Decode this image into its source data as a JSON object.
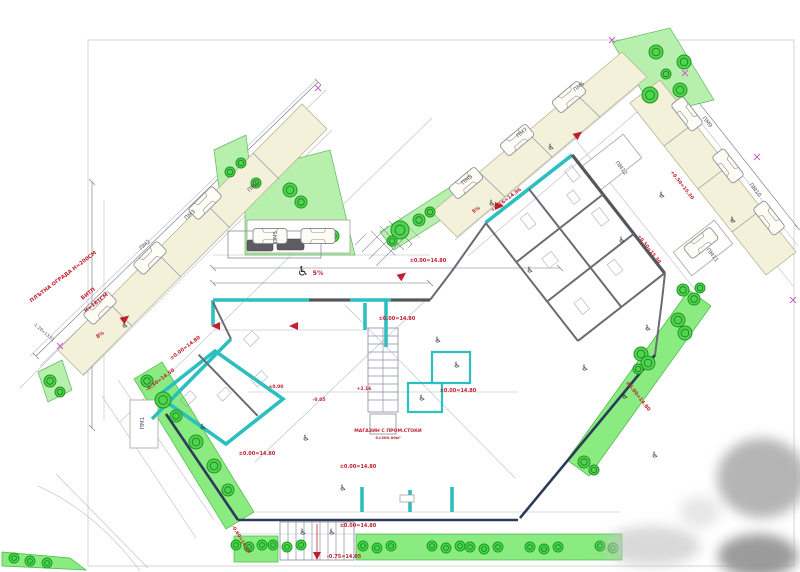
{
  "drawing": {
    "kind": "architectural site / ground-floor plan",
    "colors": {
      "wall_new_teal": "#2cbfbf",
      "wall_existing_gray": "#55575e",
      "wall_front_navy": "#2d3b58",
      "annotation_red": "#c11f2e",
      "landscape_green": "#8aeb80",
      "parking_beige": "#f4f1da",
      "survey_magenta": "#c75bc7"
    },
    "icons": {
      "wheelchair": "♿",
      "survey_cross": "✕"
    },
    "texts": [
      {
        "name": "fence-label",
        "text": "ПЛЪТНА ОГРАДА Н=200СМ",
        "x": 64,
        "y": 278,
        "rot": -37,
        "size": 5.2,
        "cls": "t-red"
      },
      {
        "name": "bitp-label-1",
        "text": "БИТП",
        "x": 89,
        "y": 295,
        "rot": -37,
        "size": 5.2,
        "cls": "t-red"
      },
      {
        "name": "bitp-label-2",
        "text": "Н=181СМ",
        "x": 97,
        "y": 304,
        "rot": -37,
        "size": 5.2,
        "cls": "t-red"
      },
      {
        "name": "level-mark",
        "text": "±0.00=14.80",
        "x": 428,
        "y": 262,
        "rot": 0,
        "size": 5,
        "cls": "t-red"
      },
      {
        "name": "level-mark",
        "text": "±0.00=14.80",
        "x": 397,
        "y": 320,
        "rot": 0,
        "size": 5,
        "cls": "t-red"
      },
      {
        "name": "level-mark",
        "text": "±0.00=14.80",
        "x": 458,
        "y": 392,
        "rot": 0,
        "size": 5,
        "cls": "t-red"
      },
      {
        "name": "level-mark",
        "text": "±0.00=14.80",
        "x": 358,
        "y": 468,
        "rot": 0,
        "size": 5,
        "cls": "t-red"
      },
      {
        "name": "level-mark",
        "text": "±0.00=14.80",
        "x": 257,
        "y": 455,
        "rot": 0,
        "size": 5,
        "cls": "t-red"
      },
      {
        "name": "level-mark",
        "text": "±0.00=14.80",
        "x": 358,
        "y": 527,
        "rot": 0,
        "size": 5,
        "cls": "t-red"
      },
      {
        "name": "level-mark",
        "text": "±0.00=14.80",
        "x": 186,
        "y": 349,
        "rot": -37,
        "size": 5,
        "cls": "t-red"
      },
      {
        "name": "level-mark",
        "text": "±0.00=14.80",
        "x": 637,
        "y": 397,
        "rot": 52,
        "size": 5,
        "cls": "t-red"
      },
      {
        "name": "level-mark",
        "text": "-0.75=14.05",
        "x": 344,
        "y": 558,
        "rot": 0,
        "size": 5,
        "cls": "t-red"
      },
      {
        "name": "level-mark",
        "text": "-0.30=14.50",
        "x": 161,
        "y": 381,
        "rot": -37,
        "size": 5,
        "cls": "t-red"
      },
      {
        "name": "level-mark",
        "text": "-0.60=14.14",
        "x": 240,
        "y": 540,
        "rot": 58,
        "size": 4.6,
        "cls": "t-red"
      },
      {
        "name": "level-mark",
        "text": "+0.16=14.96",
        "x": 507,
        "y": 201,
        "rot": -37,
        "size": 5,
        "cls": "t-red"
      },
      {
        "name": "level-mark",
        "text": "+0.50=15.30",
        "x": 681,
        "y": 186,
        "rot": 52,
        "size": 4.8,
        "cls": "t-red"
      },
      {
        "name": "level-mark",
        "text": "+0.50=15.30",
        "x": 648,
        "y": 250,
        "rot": 52,
        "size": 4.8,
        "cls": "t-red"
      },
      {
        "name": "level-mark",
        "text": "+2.16",
        "x": 364,
        "y": 390,
        "rot": 0,
        "size": 4.5,
        "cls": "t-red"
      },
      {
        "name": "level-mark",
        "text": "±0.00",
        "x": 276,
        "y": 388,
        "rot": 0,
        "size": 4.5,
        "cls": "t-red"
      },
      {
        "name": "level-mark",
        "text": "-0.05",
        "x": 319,
        "y": 401,
        "rot": 0,
        "size": 4.5,
        "cls": "t-red"
      },
      {
        "name": "shop-label",
        "text": "МАГАЗИН С ПРОМ.СТОКИ",
        "x": 388,
        "y": 432,
        "rot": 0,
        "size": 4.6,
        "cls": "t-red"
      },
      {
        "name": "shop-area",
        "text": "S=300.00м²",
        "x": 388,
        "y": 439,
        "rot": 0,
        "size": 3.8,
        "cls": "t-red"
      },
      {
        "name": "slope-label",
        "text": "5%",
        "x": 318,
        "y": 275,
        "rot": 0,
        "size": 6.5,
        "cls": "t-red"
      },
      {
        "name": "slope-label",
        "text": "5%",
        "x": 477,
        "y": 211,
        "rot": -37,
        "size": 5,
        "cls": "t-red"
      },
      {
        "name": "slope-label",
        "text": "8%",
        "x": 101,
        "y": 336,
        "rot": -37,
        "size": 5,
        "cls": "t-red"
      },
      {
        "name": "survey-level",
        "text": "-1.29=13.51",
        "x": 43,
        "y": 333,
        "rot": 41,
        "size": 4.2,
        "cls": "t-dark"
      },
      {
        "name": "parking-label",
        "text": "ПМ1",
        "x": 144,
        "y": 423,
        "rot": -90,
        "size": 5.5,
        "cls": "t-park"
      },
      {
        "name": "parking-label",
        "text": "ПМ2",
        "x": 146,
        "y": 246,
        "rot": -41,
        "size": 5.5,
        "cls": "t-park"
      },
      {
        "name": "parking-label",
        "text": "ПМ3",
        "x": 191,
        "y": 216,
        "rot": -41,
        "size": 5.5,
        "cls": "t-park"
      },
      {
        "name": "parking-label",
        "text": "ПМ4",
        "x": 254,
        "y": 188,
        "rot": -41,
        "size": 5.5,
        "cls": "t-park"
      },
      {
        "name": "parking-label",
        "text": "ПМ5",
        "x": 277,
        "y": 237,
        "rot": -90,
        "size": 5.5,
        "cls": "t-park"
      },
      {
        "name": "parking-label",
        "text": "ПМ6",
        "x": 580,
        "y": 88,
        "rot": -39,
        "size": 5.5,
        "cls": "t-park"
      },
      {
        "name": "parking-label",
        "text": "ПМ7",
        "x": 523,
        "y": 134,
        "rot": -39,
        "size": 5.5,
        "cls": "t-park"
      },
      {
        "name": "parking-label",
        "text": "ПМ8",
        "x": 468,
        "y": 181,
        "rot": -39,
        "size": 5.5,
        "cls": "t-park"
      },
      {
        "name": "parking-label",
        "text": "ПМ9",
        "x": 706,
        "y": 123,
        "rot": 52,
        "size": 5.5,
        "cls": "t-park"
      },
      {
        "name": "parking-label",
        "text": "ПМ10",
        "x": 754,
        "y": 191,
        "rot": 52,
        "size": 5.5,
        "cls": "t-park"
      },
      {
        "name": "parking-label",
        "text": "ПМ11",
        "x": 711,
        "y": 256,
        "rot": 52,
        "size": 5.5,
        "cls": "t-park"
      },
      {
        "name": "parking-label",
        "text": "ПМ12",
        "x": 620,
        "y": 169,
        "rot": 52,
        "size": 5.5,
        "cls": "t-park"
      }
    ]
  }
}
